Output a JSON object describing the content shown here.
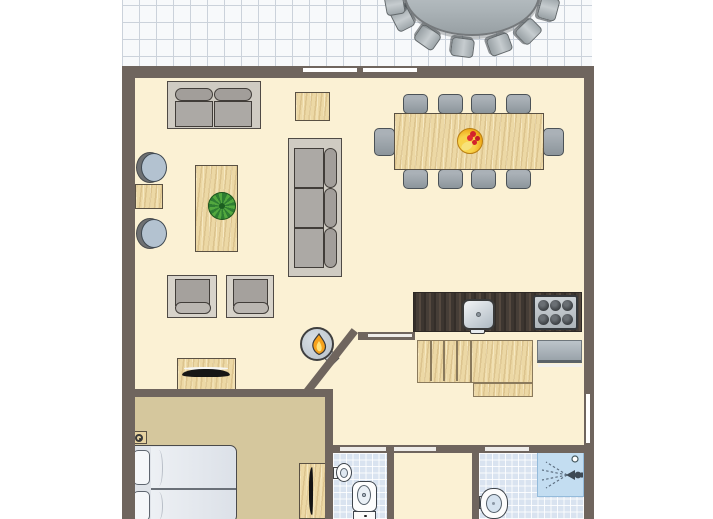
{
  "plan": {
    "label": "holiday-home floor plan with terrace, living-dining room, kitchen, bedroom and bathrooms"
  },
  "colors": {
    "wall": "#6F655E",
    "floor": "#FBF1D4",
    "bedroomFloor": "#D5C79D",
    "terraceTile": "#F7F9FB",
    "terraceLine": "#CBD2DB",
    "bathTile": "#D9E3F0",
    "wood": "#ECD8A5",
    "woodEdge": "#5A5143",
    "counterDark": "#463E37",
    "furnitureGray": "#ACA9A5",
    "chairBlue": "#B3C2D0",
    "applianceGray": "#AEB6BE",
    "showerBlue": "#C3DDF1",
    "flameOrange": "#F6A21C",
    "plantGreen": "#3E8E41",
    "fruitYellow": "#F2B52B",
    "berryRed": "#D3222B",
    "windowMarker": "#FFFFFF"
  },
  "inventory": {
    "terrace": {
      "oval_table": 1,
      "terrace_chairs_visible": 7
    },
    "living_room": {
      "sofa_2seat": 1,
      "sofa_3seat": 1,
      "armchairs": 2,
      "round_chairs": 2,
      "coffee_table": 1,
      "side_tables": 2,
      "plant": 1,
      "tv_sideboard": 1,
      "wood_stove": 1
    },
    "dining_room": {
      "table": 1,
      "chairs": 10,
      "fruit_bowl": 1
    },
    "kitchen": {
      "counter": 1,
      "sink": 1,
      "stove_burners": 6,
      "appliance": 1
    },
    "stairs": {
      "treads": 4,
      "landing": 1
    },
    "bedroom": {
      "double_bed": 1,
      "pillows": 2,
      "desk_tv": 1,
      "wall_fixture": 1
    },
    "wc": {
      "toilet": 1,
      "hand_basin": 1
    },
    "bathroom": {
      "shower": 1,
      "basin": 1
    },
    "openings": {
      "terrace_windows": 2,
      "right_wall_window": 1,
      "interior_doors": 4
    }
  }
}
